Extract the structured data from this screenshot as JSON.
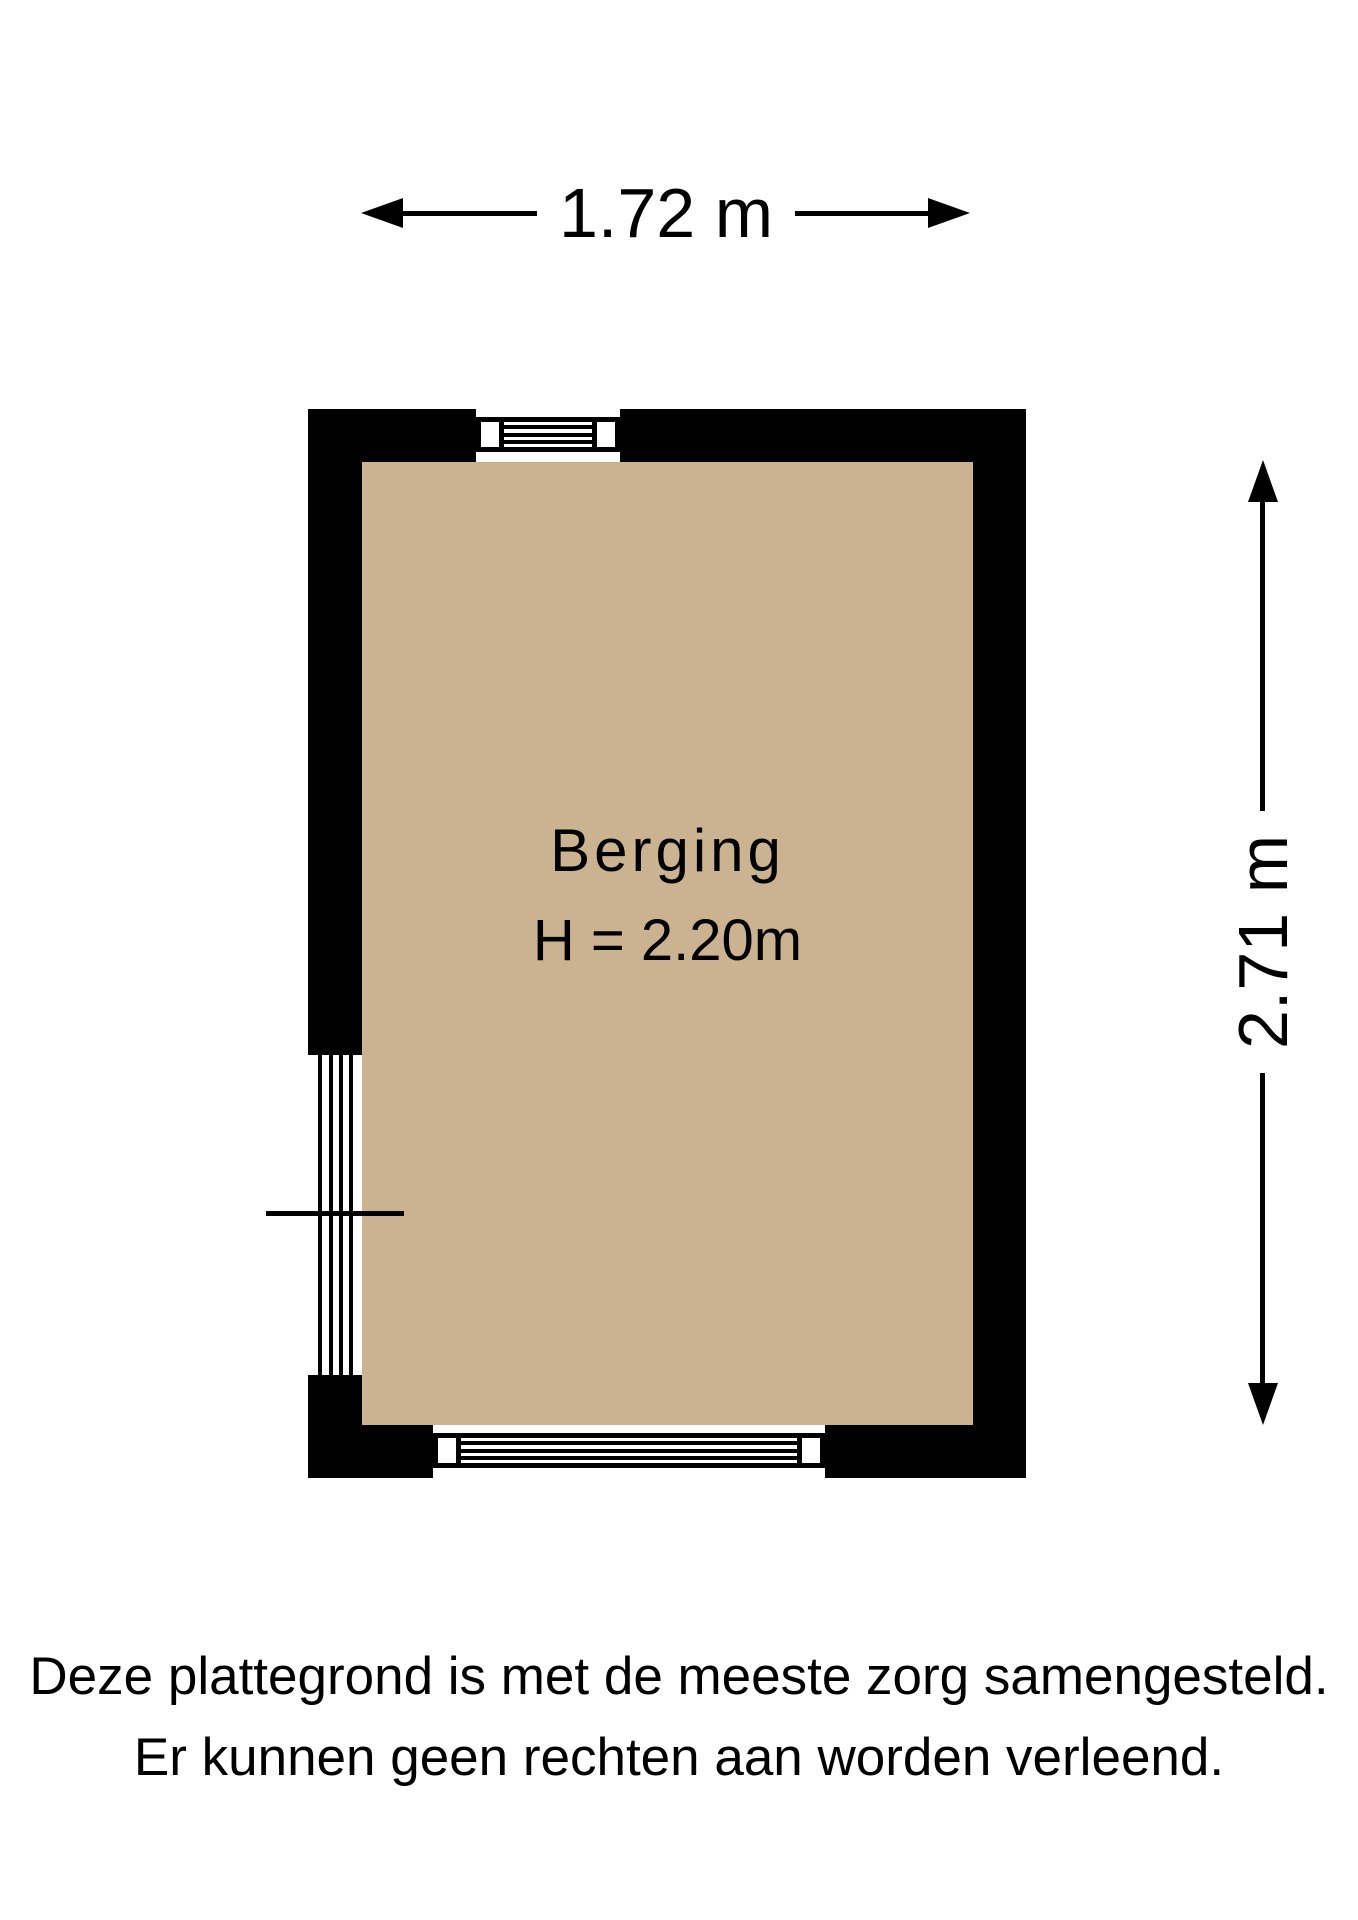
{
  "floorplan": {
    "room": {
      "name": "Berging",
      "ceiling_height": "H = 2.20m"
    },
    "dimensions": {
      "width": "1.72 m",
      "depth": "2.71 m"
    },
    "features": {
      "top_window": "window",
      "bottom_window": "window",
      "left_door": "slatted-door"
    },
    "disclaimer": {
      "line1": "Deze plattegrond is met de meeste zorg samengesteld.",
      "line2": "Er kunnen geen rechten aan worden verleend."
    },
    "colors": {
      "wall": "#000000",
      "floor": "#cbb291",
      "background": "#ffffff",
      "text": "#000000"
    }
  }
}
